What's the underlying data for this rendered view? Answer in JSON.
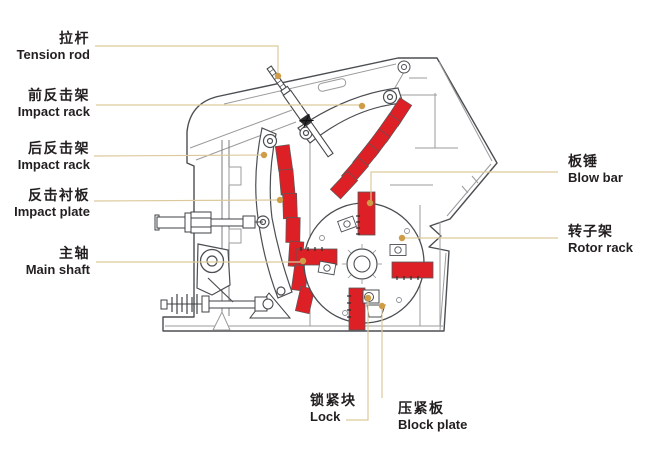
{
  "figure": {
    "type": "technical-diagram",
    "subject": "impact crusher internal structure",
    "background": "#ffffff",
    "colors": {
      "part_highlight_red": "#dc2026",
      "leader_line": "#dcc99b",
      "leader_dot": "#cf9c48",
      "outline_dark": "#4b4e52",
      "outline_light": "#9b9b9b",
      "label_text": "#231f20"
    },
    "labels": [
      {
        "id": "tension-rod",
        "zh": "拉杆",
        "en": "Tension rod"
      },
      {
        "id": "front-impact-rack",
        "zh": "前反击架",
        "en": "Impact rack"
      },
      {
        "id": "rear-impact-rack",
        "zh": "后反击架",
        "en": "Impact rack"
      },
      {
        "id": "impact-plate",
        "zh": "反击衬板",
        "en": "Impact plate"
      },
      {
        "id": "main-shaft",
        "zh": "主轴",
        "en": "Main shaft"
      },
      {
        "id": "blow-bar",
        "zh": "板锤",
        "en": "Blow bar"
      },
      {
        "id": "rotor-rack",
        "zh": "转子架",
        "en": "Rotor rack"
      },
      {
        "id": "lock",
        "zh": "锁紧块",
        "en": "Lock"
      },
      {
        "id": "block-plate",
        "zh": "压紧板",
        "en": "Block plate"
      }
    ]
  }
}
